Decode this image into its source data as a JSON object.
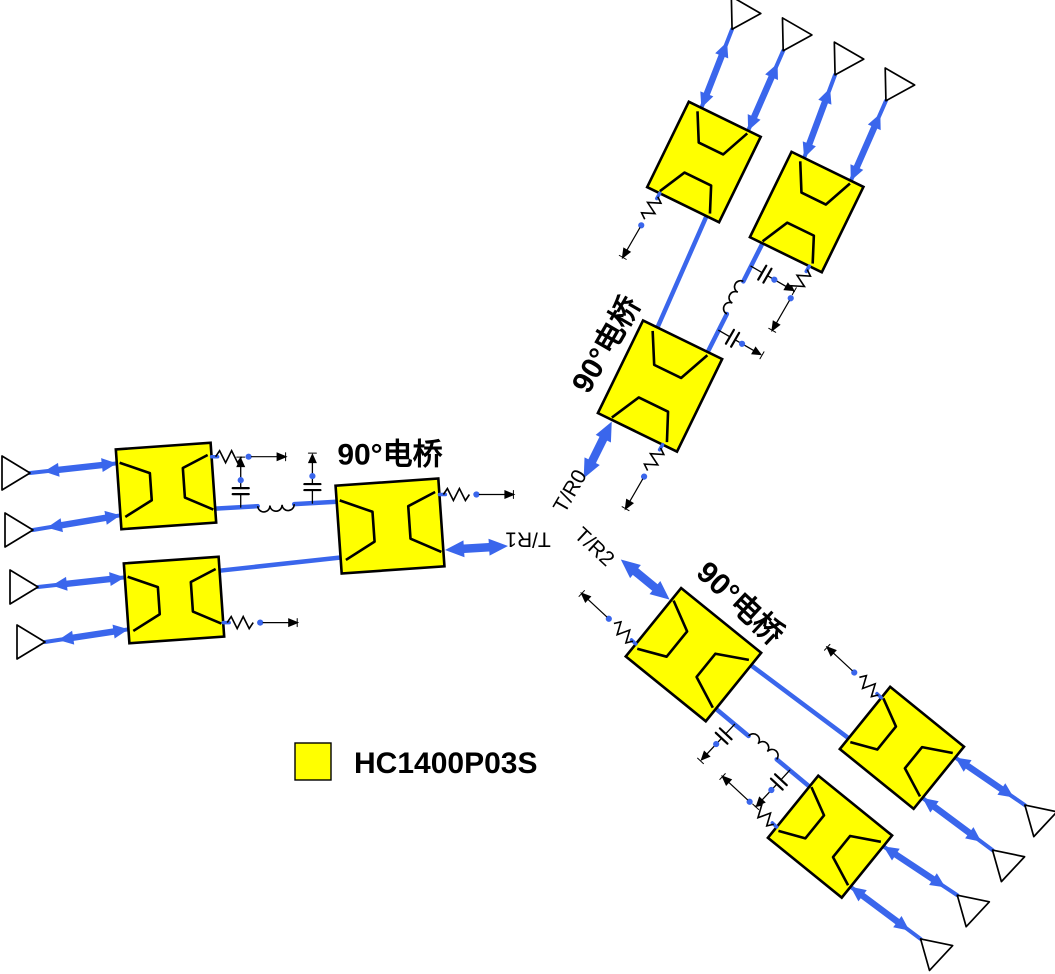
{
  "diagram": {
    "bridge_label_text": "90°电桥",
    "legend": {
      "label": "HC1400P03S",
      "swatch_color": "#ffff00"
    },
    "colors": {
      "signal": "#3a66ec",
      "component_fill": "#ffff00",
      "outline": "#000000",
      "background": "#ffffff"
    },
    "branches": [
      {
        "id": "left",
        "tr_label": "T/R1",
        "cx": 556.0,
        "cy": 546.0,
        "angle": 0,
        "bridge_label": {
          "x": -166,
          "y": -91,
          "rot": 0
        },
        "tr_label_pos": {
          "x": -28,
          "y": -7,
          "rot": 180
        }
      },
      {
        "id": "top",
        "tr_label": "T/R0",
        "cx": 559.7,
        "cy": 519.8,
        "angle": 120,
        "bridge_label": {
          "x": -175,
          "y": 47,
          "rot": 180
        },
        "tr_label_pos": {
          "x": -30,
          "y": 5,
          "rot": 180
        }
      },
      {
        "id": "bottom",
        "tr_label": "T/R2",
        "cx": 585.7,
        "cy": 526.8,
        "angle": -137,
        "bridge_label": {
          "x": -165,
          "y": 49,
          "rot": 180
        },
        "tr_label_pos": {
          "x": -20,
          "y": -9,
          "rot": 180
        }
      }
    ]
  }
}
